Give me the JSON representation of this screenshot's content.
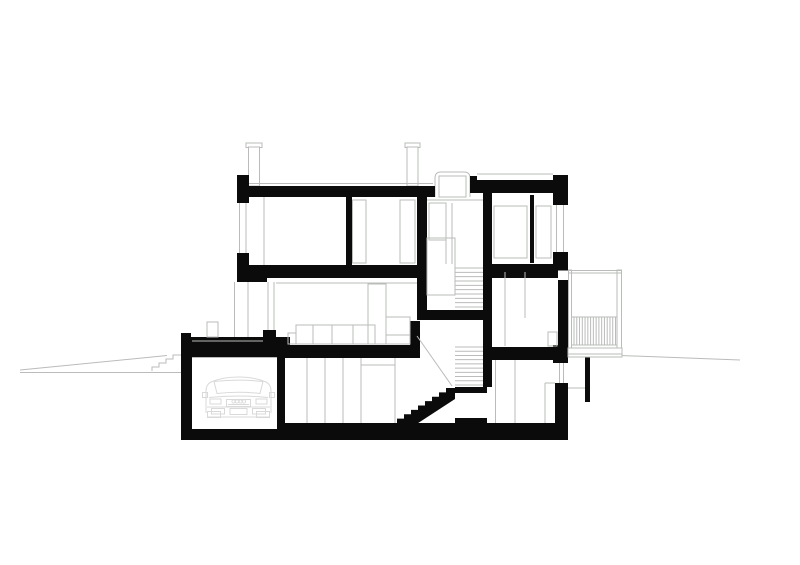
{
  "canvas": {
    "width": 800,
    "height": 565,
    "background": "#ffffff"
  },
  "colors": {
    "ink": "#0b0b0b",
    "outline": "#b9bcb9",
    "faint": "#d9d9d9",
    "white": "#ffffff"
  },
  "drawing": {
    "terrain_lines": [
      [
        20,
        372.5,
        181,
        372.5
      ],
      [
        20,
        370,
        167,
        355.5
      ],
      [
        568,
        353.5,
        740,
        360
      ],
      [
        568,
        388,
        585,
        388
      ]
    ],
    "terrain_steps_polyline": [
      [
        152,
        371
      ],
      [
        152,
        367
      ],
      [
        159,
        367
      ],
      [
        159,
        363
      ],
      [
        166,
        363
      ],
      [
        166,
        359
      ],
      [
        173,
        359
      ],
      [
        173,
        355
      ],
      [
        181,
        355
      ]
    ],
    "chimneys": [
      {
        "name": "chimney-left-cap",
        "rect": [
          246,
          143,
          16,
          4.5
        ]
      },
      {
        "name": "chimney-left-body",
        "rect": [
          248.5,
          147,
          11,
          39
        ]
      },
      {
        "name": "chimney-right-cap",
        "rect": [
          405,
          143,
          15,
          4.5
        ]
      },
      {
        "name": "chimney-right-body",
        "rect": [
          407,
          147,
          11,
          39
        ]
      }
    ],
    "skylight": {
      "outer_path": "M435,197 L435,178 Q435,172 441,172 L464,172 Q470,172 470,178 L470,197",
      "inner_rect": [
        439,
        176,
        27,
        21
      ]
    },
    "black_rects": [
      {
        "name": "left-roof-parapet",
        "rect": [
          237,
          175,
          12,
          28
        ]
      },
      {
        "name": "left-roof-slab",
        "rect": [
          249,
          186,
          186,
          11
        ]
      },
      {
        "name": "skylight-right-jamb",
        "rect": [
          470,
          176,
          7,
          17
        ]
      },
      {
        "name": "right-roof-slab",
        "rect": [
          477,
          180,
          80,
          13
        ]
      },
      {
        "name": "right-roof-parapet",
        "rect": [
          553,
          175,
          15,
          30
        ]
      },
      {
        "name": "left-window-sill",
        "rect": [
          237,
          253,
          12,
          14
        ]
      },
      {
        "name": "top-slab-edge-left",
        "rect": [
          237,
          265,
          30,
          17
        ]
      },
      {
        "name": "top-floor-slab-left",
        "rect": [
          267,
          265,
          151,
          13
        ]
      },
      {
        "name": "top-floor-slab-right",
        "rect": [
          483,
          264,
          85,
          14
        ]
      },
      {
        "name": "interior-wall-a",
        "rect": [
          346,
          195,
          6,
          70
        ]
      },
      {
        "name": "interior-wall-b",
        "rect": [
          417,
          195,
          10,
          125
        ]
      },
      {
        "name": "stairwell-wall",
        "rect": [
          483,
          190,
          9,
          197
        ]
      },
      {
        "name": "thin-partition",
        "rect": [
          530,
          195,
          4,
          68
        ]
      },
      {
        "name": "right-window-sill",
        "rect": [
          553,
          252,
          15,
          18
        ]
      },
      {
        "name": "right-wall-middle",
        "rect": [
          558,
          280,
          10,
          67
        ]
      },
      {
        "name": "terrace-parapet",
        "rect": [
          181,
          333,
          10,
          12
        ]
      },
      {
        "name": "terrace-slab",
        "rect": [
          181,
          337,
          109,
          20
        ]
      },
      {
        "name": "living-threshold",
        "rect": [
          263,
          330,
          13,
          27
        ]
      },
      {
        "name": "middle-slab-left",
        "rect": [
          267,
          345,
          145,
          13
        ]
      },
      {
        "name": "stair-step-block",
        "rect": [
          410,
          321,
          10,
          37
        ]
      },
      {
        "name": "middle-slab-right",
        "rect": [
          483,
          347,
          85,
          13
        ]
      },
      {
        "name": "right-step-block",
        "rect": [
          553,
          345,
          15,
          18
        ]
      },
      {
        "name": "half-landing-slab",
        "rect": [
          417,
          310,
          66,
          10
        ]
      },
      {
        "name": "garage-left-wall",
        "rect": [
          181,
          344,
          11,
          96
        ]
      },
      {
        "name": "garage-right-wall",
        "rect": [
          277,
          357,
          8,
          72
        ]
      },
      {
        "name": "lower-landing-slab",
        "rect": [
          455,
          387,
          32,
          6
        ]
      },
      {
        "name": "lower-landing-floor",
        "rect": [
          455,
          418,
          32,
          10
        ]
      },
      {
        "name": "right-lower-wall",
        "rect": [
          555,
          383,
          13,
          45
        ]
      },
      {
        "name": "bottom-slab",
        "rect": [
          181,
          423,
          387,
          17
        ]
      },
      {
        "name": "site-post",
        "rect": [
          585,
          357,
          5,
          45
        ]
      }
    ],
    "white_carves": [
      {
        "name": "garage-interior",
        "rect": [
          192,
          357,
          85,
          72
        ]
      },
      {
        "name": "basement-mid-room",
        "rect": [
          285,
          358,
          120,
          65
        ]
      },
      {
        "name": "lower-landing-room",
        "rect": [
          455,
          393,
          32,
          25
        ]
      },
      {
        "name": "basement-right-room",
        "rect": [
          492,
          360,
          61,
          63
        ]
      },
      {
        "name": "right-wall-notch",
        "rect": [
          558,
          270.5,
          10,
          9
        ]
      }
    ],
    "stair_flight_polygon": "397,423 397,418.6 404,418.6 404,414.2 411,414.2 411,409.9 418,409.9 418,405.5 425,405.5 425,401.1 432,401.1 432,396.8 439,396.8 439,392.4 446,392.4 446,388 455,388 455,399 409,429 397,429",
    "tread_groups": [
      {
        "name": "upper-stair-treads",
        "x1": 455,
        "x2": 483,
        "y1": 268,
        "y2": 307,
        "count": 10
      },
      {
        "name": "mid-stair-treads",
        "x1": 455,
        "x2": 483,
        "y1": 347,
        "y2": 385,
        "count": 10
      }
    ],
    "outlined_white_rects": [
      {
        "name": "stair-balustrade",
        "rect": [
          427,
          238,
          28,
          57
        ]
      },
      {
        "name": "balcony-floor",
        "rect": [
          568,
          348,
          54,
          9
        ]
      }
    ],
    "light_rects": [
      {
        "name": "closet-left",
        "rect": [
          352.5,
          200,
          13.5,
          63
        ]
      },
      {
        "name": "closet-right",
        "rect": [
          400,
          200,
          15,
          63
        ]
      },
      {
        "name": "stair-door-frame",
        "rect": [
          429,
          203,
          17,
          37
        ]
      },
      {
        "name": "top-right-window-a",
        "rect": [
          494,
          206,
          33,
          52
        ]
      },
      {
        "name": "top-right-window-b",
        "rect": [
          536,
          206,
          15,
          52
        ]
      },
      {
        "name": "living-cabinet",
        "rect": [
          368,
          284,
          18,
          60
        ]
      },
      {
        "name": "living-counter",
        "rect": [
          386,
          317,
          24,
          27
        ]
      },
      {
        "name": "sofa-seat",
        "rect": [
          296,
          325,
          79,
          19
        ]
      },
      {
        "name": "sofa-armrest",
        "rect": [
          288,
          333,
          8,
          11
        ]
      },
      {
        "name": "mid-right-box",
        "rect": [
          548,
          332,
          9,
          14
        ]
      },
      {
        "name": "terrace-box",
        "rect": [
          207,
          322,
          11,
          15
        ]
      }
    ],
    "light_lines": [
      [
        249,
        183.5,
        433,
        183.5
      ],
      [
        477,
        174,
        553,
        174
      ],
      [
        239.5,
        203,
        239.5,
        253
      ],
      [
        246,
        203,
        246,
        253
      ],
      [
        556.5,
        205,
        556.5,
        252
      ],
      [
        563.5,
        205,
        563.5,
        252
      ],
      [
        268,
        282,
        268,
        330
      ],
      [
        274,
        282,
        274,
        330
      ],
      [
        559.5,
        363,
        559.5,
        383
      ],
      [
        563.5,
        363,
        563.5,
        383
      ],
      [
        234.5,
        282,
        234.5,
        337
      ],
      [
        248,
        282,
        248,
        337
      ],
      [
        192,
        341,
        263,
        341
      ],
      [
        264,
        197,
        264,
        265
      ],
      [
        427,
        200,
        483,
        200
      ],
      [
        446,
        203,
        446,
        264
      ],
      [
        452,
        203,
        452,
        264
      ],
      [
        276,
        283,
        417,
        283
      ],
      [
        386,
        335,
        410,
        335
      ],
      [
        313,
        325,
        313,
        344
      ],
      [
        332,
        325,
        332,
        344
      ],
      [
        353,
        325,
        353,
        344
      ],
      [
        307,
        358,
        307,
        423
      ],
      [
        325,
        358,
        325,
        423
      ],
      [
        343,
        358,
        343,
        423
      ],
      [
        361,
        358,
        361,
        423
      ],
      [
        395,
        358,
        395,
        423
      ],
      [
        361,
        365,
        395,
        365
      ],
      [
        192,
        357.5,
        277,
        357.5
      ],
      [
        505,
        272,
        505,
        346
      ],
      [
        525,
        272,
        525,
        318
      ],
      [
        495.5,
        360,
        495.5,
        423
      ],
      [
        515,
        360,
        515,
        423
      ],
      [
        545,
        383,
        545,
        423
      ],
      [
        545,
        383,
        555,
        383
      ],
      [
        417,
        336,
        452,
        386
      ]
    ],
    "balcony": {
      "posts": [
        [
          568.5,
          270,
          3,
          78
        ],
        [
          617,
          270,
          4.5,
          78
        ]
      ],
      "rail_lines": [
        [
          568,
          270.5,
          622,
          270.5
        ],
        [
          568,
          273,
          622,
          273
        ],
        [
          572,
          317,
          617,
          317
        ],
        [
          572,
          345,
          617,
          345
        ],
        [
          568,
          354,
          622,
          354
        ]
      ],
      "balusters": {
        "x1": 574,
        "x2": 615.5,
        "y1": 317,
        "y2": 345,
        "count": 16
      }
    },
    "car": {
      "paths": [
        "M206,413 L206,391 Q206,384.5 211,382 Q223,377 238.5,377 Q254,377 266,382 Q271,384.5 271,391 L271,413",
        "M214,381.5 Q238.5,378.8 263,381.5 L260,393.5 Q238.5,391 217,393.5 Z",
        "M209,397.5 Q238.5,394.5 268,397.5"
      ],
      "rects": [
        [
          202.5,
          392.5,
          5,
          5
        ],
        [
          269.5,
          392.5,
          5,
          5
        ],
        [
          210,
          399,
          11,
          5
        ],
        [
          256,
          399,
          11,
          5
        ],
        [
          226.5,
          399.5,
          24,
          7
        ],
        [
          230,
          408.5,
          17,
          6
        ],
        [
          211.5,
          408.5,
          13,
          5.5
        ],
        [
          252.5,
          408.5,
          13,
          5.5
        ],
        [
          207.5,
          411.5,
          13,
          6
        ],
        [
          256.5,
          411.5,
          13,
          6
        ]
      ],
      "lines": [
        [
          207,
          407,
          270,
          407
        ],
        [
          208,
          417,
          269,
          417
        ],
        [
          228,
          404.5,
          249,
          404.5
        ]
      ],
      "circles": [
        [
          233.5,
          401.5,
          1.6
        ],
        [
          237,
          401.5,
          1.6
        ],
        [
          240.5,
          401.5,
          1.6
        ],
        [
          244,
          401.5,
          1.6
        ]
      ]
    }
  }
}
